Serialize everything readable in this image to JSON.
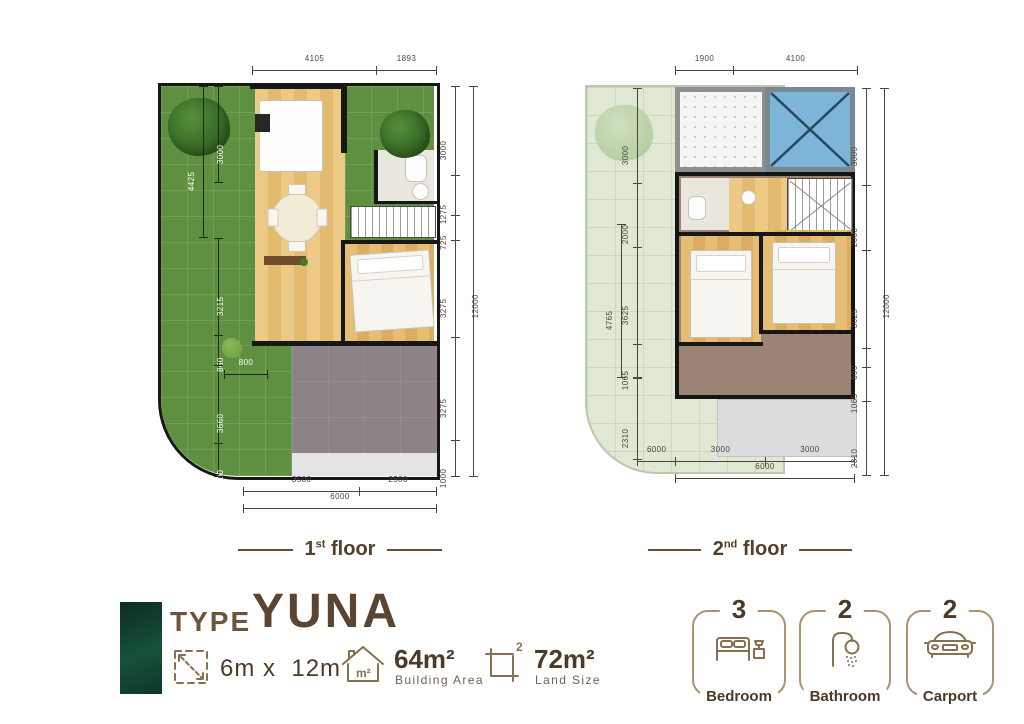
{
  "floors": {
    "floor1": {
      "title": {
        "num": "1",
        "sup": "st",
        "word": "floor"
      },
      "dims": {
        "top": [
          "4105",
          "1893"
        ],
        "right": [
          "3000",
          "1275",
          "725",
          "3275",
          "3275",
          "1000"
        ],
        "right_total": "12000",
        "lawn_top": "3000",
        "lawn_left_outer": "4425",
        "lawn_left": [
          "3215",
          "860"
        ],
        "lawn_gate": "800",
        "lawn_bottom": [
          "3660",
          "1000"
        ],
        "bottom": [
          "3500",
          "2500"
        ],
        "bottom_total": "6000"
      }
    },
    "floor2": {
      "title": {
        "num": "2",
        "sup": "nd",
        "word": "floor"
      },
      "dims": {
        "top": [
          "1900",
          "4100"
        ],
        "left": [
          "3000",
          "2000",
          "3625",
          "1065"
        ],
        "left_outer": "4765",
        "left_bottom": "2310",
        "right": [
          "3000",
          "2000",
          "3025",
          "600",
          "1065",
          "2310"
        ],
        "right_total": "12000",
        "bottom": [
          "6000",
          "3000",
          "3000"
        ],
        "bottom_total": "6000"
      }
    }
  },
  "info": {
    "type_label": "TYPE",
    "type_name": "YUNA",
    "dimension_value": "6m x  12m",
    "building_area": {
      "value": "64m²",
      "label": "Building Area"
    },
    "land_size": {
      "value": "72m²",
      "label": "Land Size"
    },
    "house_icon_text": "m²",
    "land_icon_sup": "2"
  },
  "badges": [
    {
      "count": "3",
      "label": "Bedroom",
      "icon": "bed-icon"
    },
    {
      "count": "2",
      "label": "Bathroom",
      "icon": "shower-icon"
    },
    {
      "count": "2",
      "label": "Carport",
      "icon": "car-icon"
    }
  ],
  "colors": {
    "accent_brown": "#5b4530",
    "tan": "#ab9270",
    "dark_green": "#123f30",
    "lawn_green": "#5e9040",
    "skylight_blue": "#7cb5d8"
  }
}
